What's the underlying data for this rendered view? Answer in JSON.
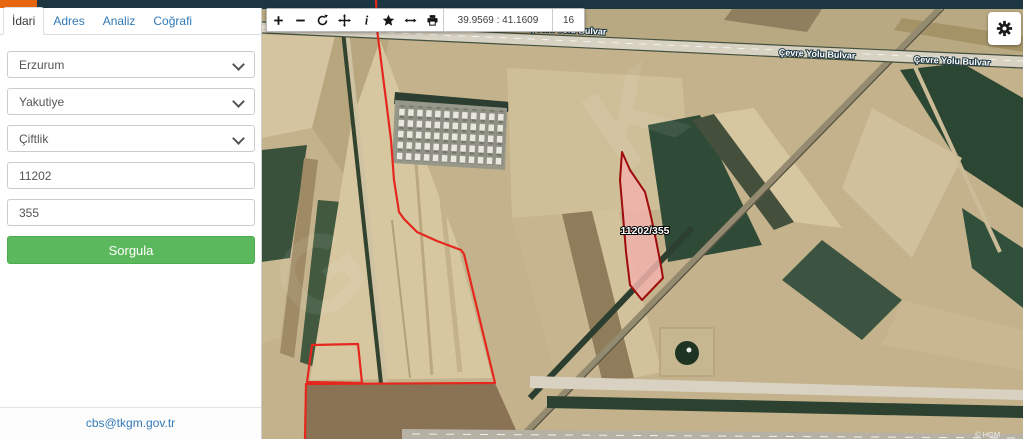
{
  "app": {
    "topbar_color": "#1d3742",
    "brand_color": "#e8650f"
  },
  "sidebar": {
    "tabs": [
      {
        "label": "İdari",
        "active": true
      },
      {
        "label": "Adres",
        "active": false
      },
      {
        "label": "Analiz",
        "active": false
      },
      {
        "label": "Coğrafi",
        "active": false
      }
    ],
    "form": {
      "province": {
        "value": "Erzurum"
      },
      "district": {
        "value": "Yakutiye"
      },
      "neighborhood": {
        "value": "Çiftlik"
      },
      "block_input": {
        "value": "11202"
      },
      "parcel_input": {
        "value": "355"
      },
      "query_button_label": "Sorgula"
    },
    "footer": {
      "link": "cbs@tkgm.gov.tr"
    }
  },
  "map": {
    "toolbar": {
      "icons": [
        "zoom-in",
        "zoom-out",
        "refresh",
        "pan",
        "info",
        "favorites",
        "measure-distance",
        "print"
      ],
      "coordinates": "39.9569 : 41.1609",
      "zoom_level": "16"
    },
    "road_label": "Çevre Yolu Bulvar",
    "selected_parcel": {
      "label": "11202/355",
      "fill": "#f2b3ab",
      "stroke": "#9e0b0b"
    },
    "boundary_color": "#e5271d",
    "attribution": "© HGM",
    "watermark_letters": [
      "K",
      "G"
    ]
  }
}
